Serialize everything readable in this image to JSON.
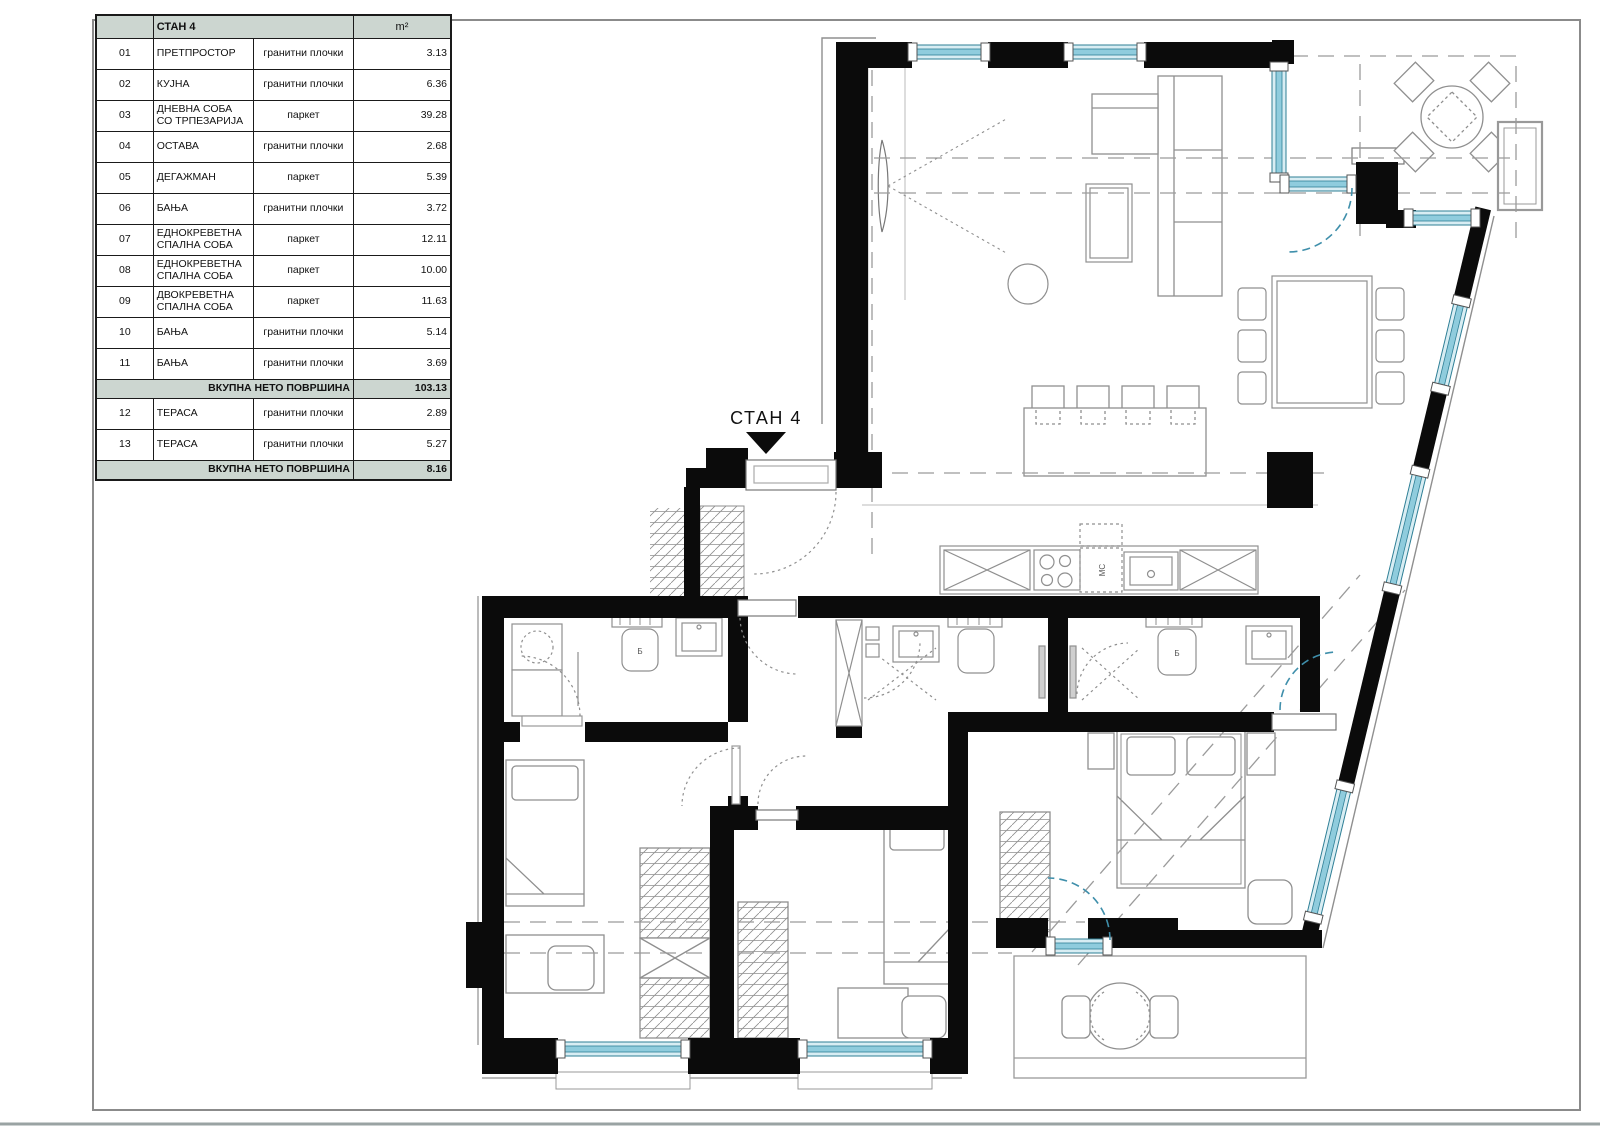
{
  "plan": {
    "apartment_label": "СТАН 4",
    "toilet_label": "Б",
    "kitchen_sink_label": "МС"
  },
  "table": {
    "title": "СТАН 4",
    "area_unit": "m²",
    "rows_main": [
      {
        "num": "01",
        "name": "ПРЕТПРОСТОР",
        "floor": "гранитни плочки",
        "area": "3.13"
      },
      {
        "num": "02",
        "name": "КУЈНА",
        "floor": "гранитни плочки",
        "area": "6.36"
      },
      {
        "num": "03",
        "name": "ДНЕВНА СОБА СО ТРПЕЗАРИЈА",
        "floor": "паркет",
        "area": "39.28"
      },
      {
        "num": "04",
        "name": "ОСТАВА",
        "floor": "гранитни плочки",
        "area": "2.68"
      },
      {
        "num": "05",
        "name": "ДЕГАЖМАН",
        "floor": "паркет",
        "area": "5.39"
      },
      {
        "num": "06",
        "name": "БАЊА",
        "floor": "гранитни плочки",
        "area": "3.72"
      },
      {
        "num": "07",
        "name": "ЕДНОКРЕВЕТНА СПАЛНА СОБА",
        "floor": "паркет",
        "area": "12.11"
      },
      {
        "num": "08",
        "name": "ЕДНОКРЕВЕТНА СПАЛНА СОБА",
        "floor": "паркет",
        "area": "10.00"
      },
      {
        "num": "09",
        "name": "ДВОКРЕВЕТНА СПАЛНА СОБА",
        "floor": "паркет",
        "area": "11.63"
      },
      {
        "num": "10",
        "name": "БАЊА",
        "floor": "гранитни плочки",
        "area": "5.14"
      },
      {
        "num": "11",
        "name": "БАЊА",
        "floor": "гранитни плочки",
        "area": "3.69"
      }
    ],
    "subtotal": {
      "label": "ВКУПНА НЕТО ПОВРШИНА",
      "value": "103.13"
    },
    "rows_terrace": [
      {
        "num": "12",
        "name": "ТЕРАСА",
        "floor": "гранитни плочки",
        "area": "2.89"
      },
      {
        "num": "13",
        "name": "ТЕРАСА",
        "floor": "гранитни плочки",
        "area": "5.27"
      }
    ],
    "total_terrace": {
      "label": "ВКУПНА НЕТО ПОВРШИНА",
      "value": "8.16"
    }
  },
  "colors": {
    "wall": "#0b0b0b",
    "window_fill": "#d8edf3",
    "window_band": "#8fccdd",
    "window_frame": "#2e7f96",
    "header_bg": "#ccd6d0",
    "door_arc_blue": "#3f8fab",
    "thin_line": "#8f8f8f"
  }
}
